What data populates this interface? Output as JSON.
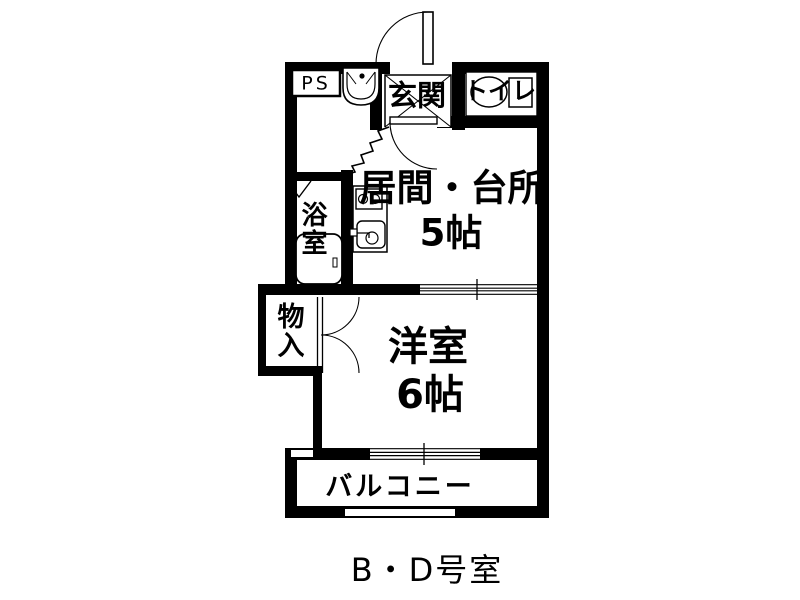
{
  "plan_labels": {
    "ps": "PS",
    "entrance": "玄関",
    "toilet": "トイレ",
    "bathroom": "浴室",
    "living_kitchen": "居間・台所",
    "living_kitchen_size": "5帖",
    "closet": "物入",
    "western_room": "洋室",
    "western_room_size": "6帖",
    "balcony": "バルコニー"
  },
  "caption": "B・D号室",
  "colors": {
    "line": "#000000",
    "background": "#ffffff"
  }
}
